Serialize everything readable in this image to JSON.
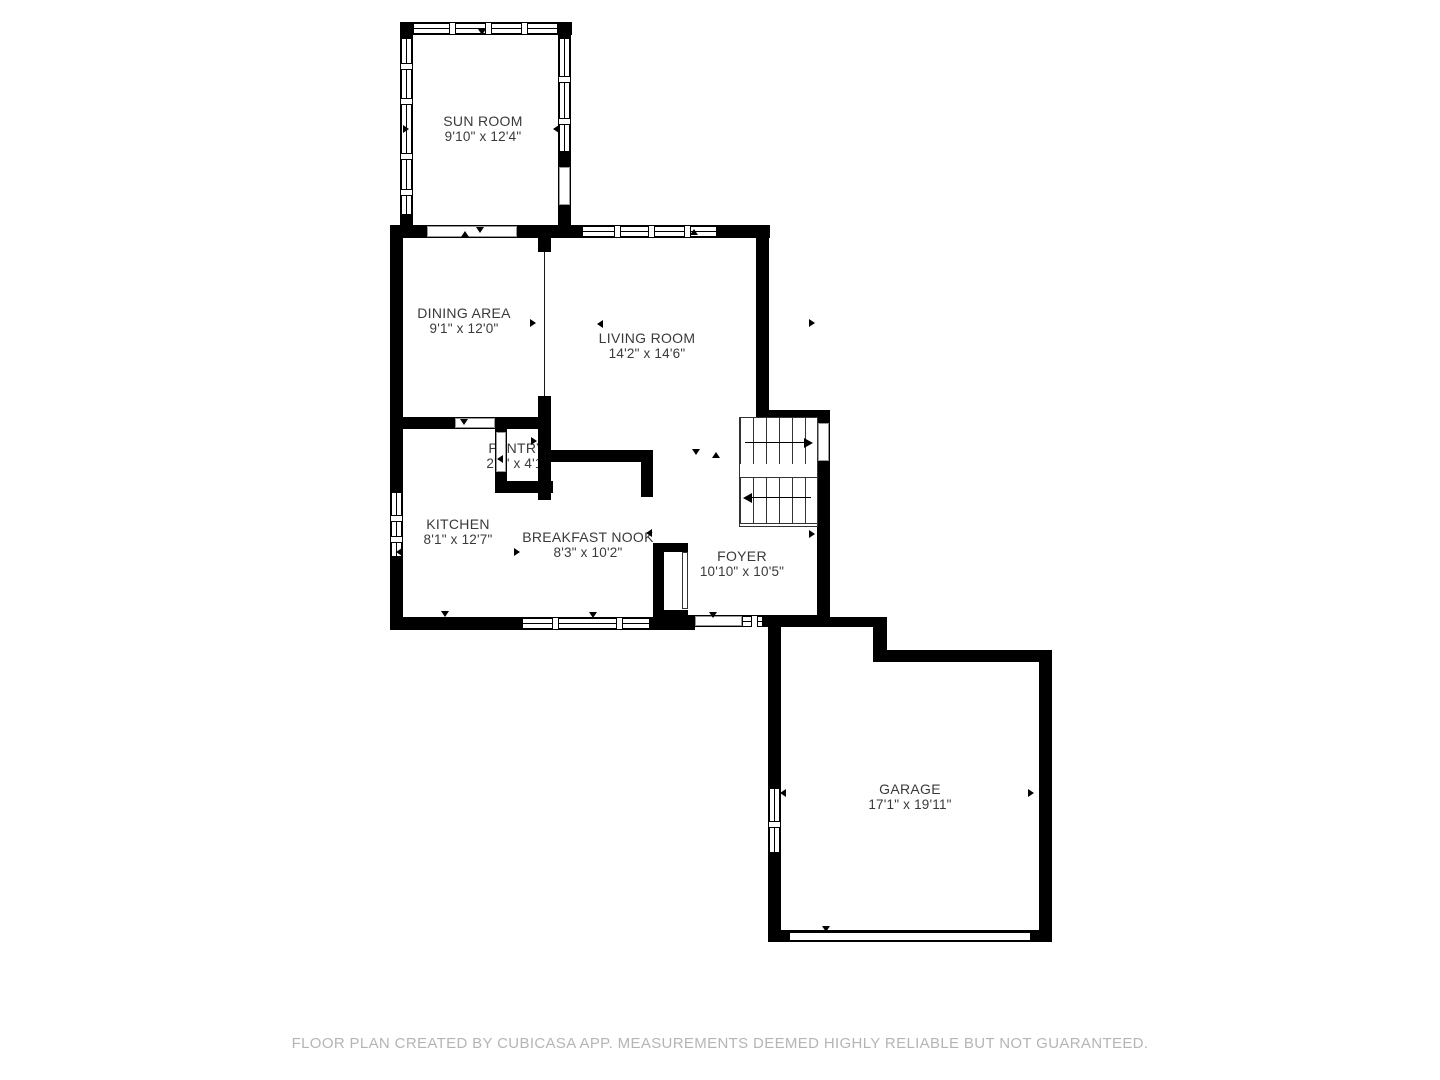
{
  "colors": {
    "wall": "#000000",
    "label_text": "#3a3a3a",
    "footer_text": "#b5b5b5",
    "background": "#ffffff"
  },
  "rooms": [
    {
      "name": "SUN ROOM",
      "dims": "9'10\" x 12'4\""
    },
    {
      "name": "DINING AREA",
      "dims": "9'1\" x 12'0\""
    },
    {
      "name": "LIVING ROOM",
      "dims": "14'2\" x 14'6\""
    },
    {
      "name": "PANTRY",
      "dims": "2'4\" x 4'1\""
    },
    {
      "name": "KITCHEN",
      "dims": "8'1\" x 12'7\""
    },
    {
      "name": "BREAKFAST NOOK",
      "dims": "8'3\" x 10'2\""
    },
    {
      "name": "FOYER",
      "dims": "10'10\" x 10'5\""
    },
    {
      "name": "GARAGE",
      "dims": "17'1\" x 19'11\""
    }
  ],
  "footer": {
    "text": "FLOOR PLAN CREATED BY CUBICASA APP. MEASUREMENTS DEEMED HIGHLY RELIABLE BUT NOT GUARANTEED."
  }
}
